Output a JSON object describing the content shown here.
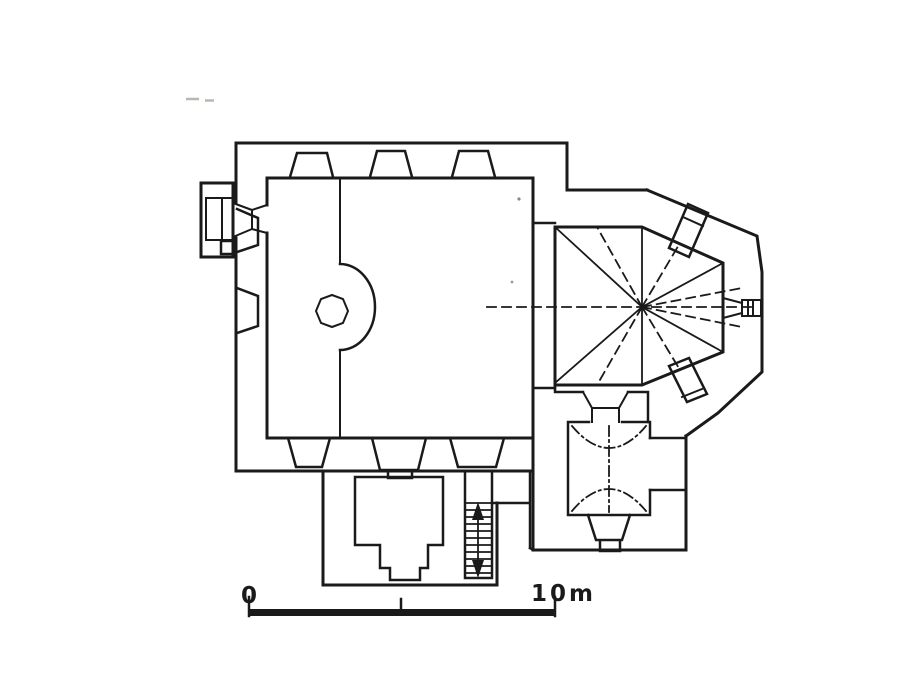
{
  "drawing": {
    "type": "architectural-floor-plan",
    "subject": "single-nave church ground plan with polygonal star-vaulted apse, sacristy, south chapel, west portal, spiral stair and staircase",
    "background_color": "#ffffff",
    "ink_color": "#1a1a1a",
    "faint_artifact_color": "#b8b8b0",
    "line_styles": {
      "walls": "solid thick",
      "vault_ribs": "solid thin",
      "axes_and_hidden_edges": "dashed",
      "vault_above_cut_plane": "dash-dot"
    },
    "features": [
      "nave",
      "west-portal-porch",
      "wall-pilasters-north",
      "wall-pilasters-west",
      "wall-pilasters-south",
      "spiral-stair-turret-with-newel",
      "choir-square-with-star-vault",
      "polygonal-apse",
      "diagonal-corner-piers",
      "east-window-splayed",
      "sacristy-with-dash-dot-vault",
      "east-wall-niche",
      "south-chapel-with-stepped-door",
      "staircase-with-direction-arrow",
      "scale-bar"
    ]
  },
  "scale_bar": {
    "zero_label": "0",
    "end_label": "10m",
    "ticks": [
      "start",
      "middle",
      "end"
    ]
  }
}
